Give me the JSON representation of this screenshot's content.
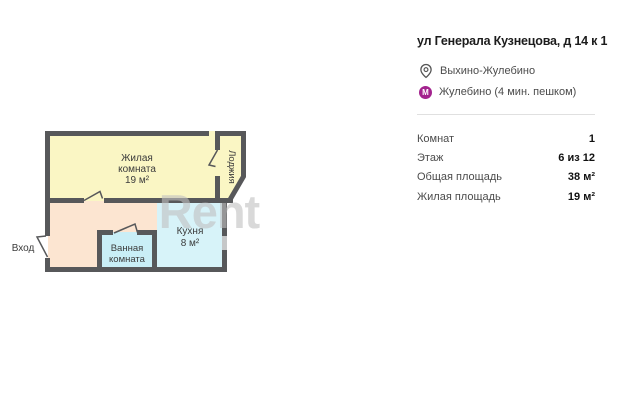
{
  "floorplan": {
    "watermark": "Rent",
    "entrance_label": "Вход",
    "rooms": {
      "living": {
        "name_line1": "Жилая",
        "name_line2": "комната",
        "area": "19 м²"
      },
      "loggia": {
        "name": "Лоджия"
      },
      "bathroom": {
        "name_line1": "Ванная",
        "name_line2": "комната"
      },
      "kitchen": {
        "name": "Кухня",
        "area": "8 м²"
      }
    },
    "colors": {
      "wall": "#57585a",
      "living": "#faf6c4",
      "hallway": "#fce5d1",
      "bathroom": "#c9eef6",
      "kitchen": "#d7f3f9",
      "window": "#c5c7c8",
      "watermark": "#c0c0c0"
    }
  },
  "details": {
    "title": "ул Генерала Кузнецова, д 14 к 1",
    "district": "Выхино-Жулебино",
    "metro": {
      "label": "Жулебино (4 мин. пешком)",
      "icon_letter": "М",
      "color": "#a3238e"
    },
    "specs": [
      {
        "label": "Комнат",
        "value": "1"
      },
      {
        "label": "Этаж",
        "value": "6 из 12"
      },
      {
        "label": "Общая площадь",
        "value": "38 м²"
      },
      {
        "label": "Жилая площадь",
        "value": "19 м²"
      }
    ]
  }
}
